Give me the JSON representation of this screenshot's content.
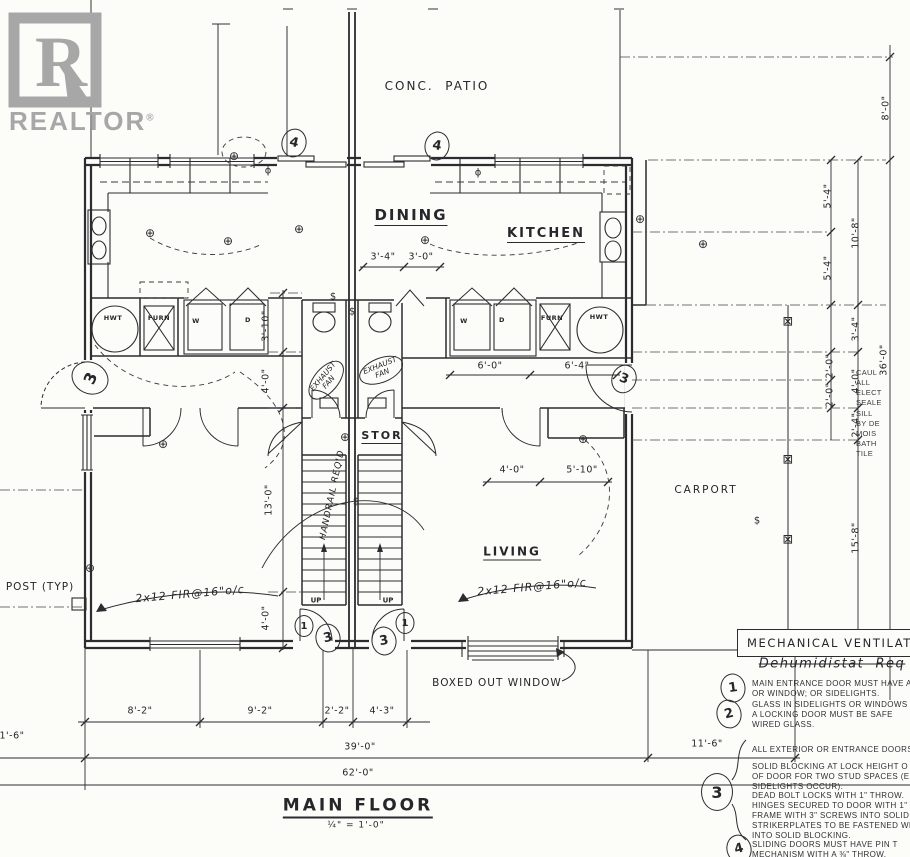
{
  "logo": {
    "letter": "R",
    "brand": "REALTOR",
    "reg": "®"
  },
  "title_block": {
    "title": "MAIN FLOOR",
    "scale": "¼\" = 1'-0\""
  },
  "rooms": {
    "patio": "CONC.  PATIO",
    "dining": "DINING",
    "kitchen": "KITCHEN",
    "stor": "STOR",
    "living": "LIVING",
    "carport": "CARPORT",
    "up_left": "UP",
    "up_right": "UP"
  },
  "fixtures": {
    "hwt_l": "HWT",
    "furn_l": "FURN",
    "w_l": "W",
    "d_l": "D",
    "w_r": "W",
    "d_r": "D",
    "furn_r": "FURN",
    "hwt_r": "HWT"
  },
  "ann": {
    "post": "POST (TYP)",
    "joist_l": "2x12 FIR@16\"o/c",
    "joist_r": "2x12 FIR@16\"o/c",
    "exh_l": "EXHAUST\nFAN",
    "exh_r": "EXHAUST\nFAN",
    "handrail": "HANDRAIL REQ'D",
    "boxed": "BOXED OUT WINDOW",
    "dehum": "Dehumidistat  Req"
  },
  "dims": {
    "d8_0": "8'-0\"",
    "d5_4a": "5'-4\"",
    "d5_4b": "5'-4\"",
    "d10_8": "10'-8\"",
    "d3_4r": "3'-4\"",
    "d2_0a": "2'-0\"",
    "d2_0b": "2'-0\"",
    "d4_0r": "4'-0\"",
    "d2_4": "2'-4\"",
    "d36_0": "36'-0\"",
    "d15_8": "15'-8\"",
    "d3_10": "3'-10\"",
    "d4_0a": "4'-0\"",
    "d13_0": "13'-0\"",
    "d4_0b": "4'-0\"",
    "d3_4d": "3'-4\"",
    "d3_0d": "3'-0\"",
    "d6_0": "6'-0\"",
    "d6_4": "6'-4\"",
    "d4_0c": "4'-0\"",
    "d5_10": "5'-10\"",
    "d8_2": "8'-2\"",
    "d9_2": "9'-2\"",
    "d2_2": "2'-2\"",
    "d4_3": "4'-3\"",
    "d39_0": "39'-0\"",
    "d62_0": "62'-0\"",
    "d11_6": "11'-6\"",
    "d1_6": "1'-6\""
  },
  "marks": {
    "m4a": "4",
    "m4b": "4",
    "m3_left": "3",
    "m3_right": "3",
    "m1_el": "1",
    "m3_el": "3",
    "m3_er": "3",
    "m1_er": "1",
    "n1": "1",
    "n2": "2",
    "n3": "3",
    "n4": "4"
  },
  "notes": {
    "mech": "MECHANICAL VENTILATION IS",
    "n1": "MAIN ENTRANCE DOOR MUST HAVE A\nOR WINDOW; OR SIDELIGHTS.",
    "n2": "GLASS IN SIDELIGHTS OR WINDOWS W\nA LOCKING DOOR MUST BE SAFE\nWIRED GLASS.",
    "n3a": "ALL EXTERIOR OR ENTRANCE DOORS",
    "n3b": "SOLID BLOCKING AT LOCK HEIGHT O\nOF DOOR FOR TWO STUD SPACES (E\nSIDELIGHTS OCCUR).",
    "n3c": "DEAD BOLT LOCKS WITH 1\" THROW.",
    "n3d": "HINGES SECURED TO DOOR WITH 1\" SC\nFRAME WITH 3\" SCREWS INTO SOLID",
    "n3e": "STRIKERPLATES TO BE FASTENED WIT\nINTO SOLID BLOCKING.",
    "n4": "SLIDING DOORS MUST HAVE PIN T\nMECHANISM WITH A ⅜\" THROW.",
    "frag": "CAUL\nALL\nELECT\nSEALE\nSILL\nBY DE\nMOIS\nBATH\nTILE"
  },
  "sym": {
    "light": "⊕",
    "switch": "$",
    "outlet": "ϕ",
    "post": "⊠"
  },
  "colors": {
    "ink": "#2c2c30",
    "logo_gray": "#a7a7a7",
    "paper": "#fcfcf9"
  }
}
